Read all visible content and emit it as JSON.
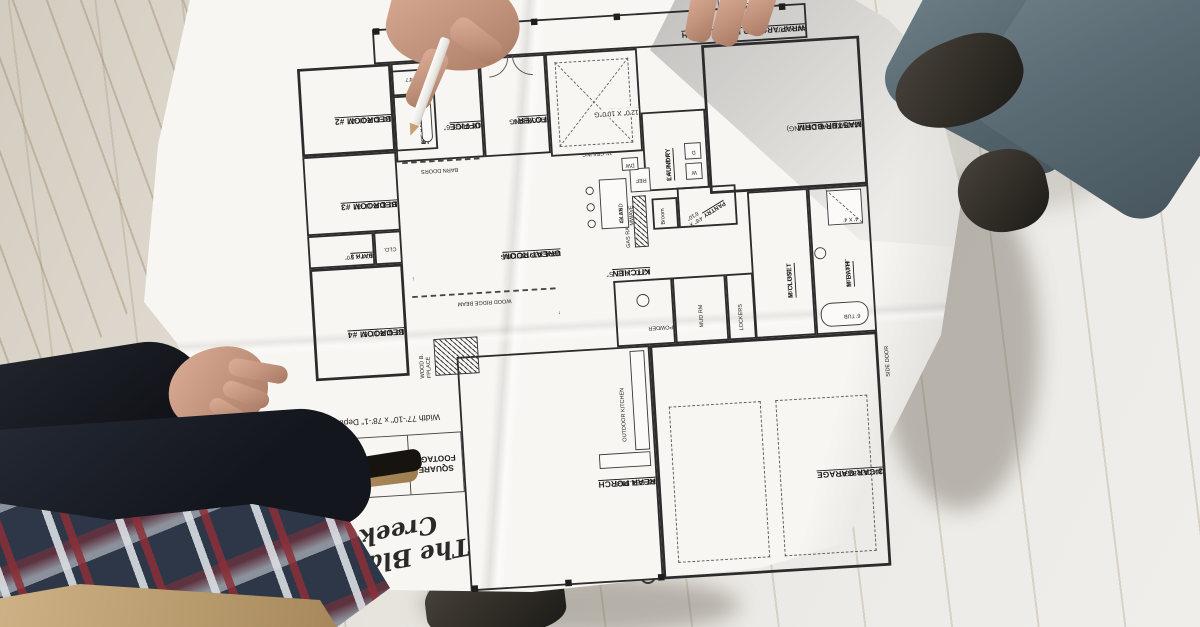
{
  "title_block": {
    "plan_title": "The Black Creek",
    "dimensions_note": "Width 77'-10\" x 78'-1\" Depth",
    "square_footage": {
      "header": "SQUARE FOOTAGE",
      "rows": [
        {
          "label": "LIVING",
          "value": "2400"
        },
        {
          "label": "TOTAL SQ. FT.",
          "value": "4064"
        }
      ]
    }
  },
  "rooms": {
    "front_porch": {
      "name": "WRAP AROUND FRONT PORCH",
      "dims": "44' X 6'0\""
    },
    "rear_porch": {
      "name": "REAR PORCH",
      "ceiling": "10' CEILING",
      "dims": "31'-8\" X 13'-6\""
    },
    "garage": {
      "name": "3-CAR GARAGE",
      "ceiling": "10' CEILING",
      "dims": "24'-0\" X 37'-4\""
    },
    "side_door": {
      "name": "SIDE DOOR"
    },
    "foyer": {
      "name": "FOYER",
      "ceiling": "11' CEILING",
      "dims": "7'-0\" X 8'-6\""
    },
    "dining": {
      "name": "DINING",
      "ceiling": "12' TRAY CLG",
      "dims": "12'0\" X 10'0\""
    },
    "office": {
      "name": "OFFICE",
      "ceiling": "10' CLG",
      "dims": "12'-0 X 8'-6\""
    },
    "great_room": {
      "name": "GREAT ROOM",
      "ceiling": "VAULTED CEILING",
      "dims": "19'-4 X 19'-8\""
    },
    "kitchen": {
      "name": "KITCHEN",
      "dims": "12'-0\" X 18'-5\"",
      "note": "11' CEILING"
    },
    "island": {
      "name": "ISLAND",
      "dims": "4X 8'6"
    },
    "bedroom2": {
      "name": "BEDROOM #2",
      "ceiling": "10' CLG",
      "dims": "11'-2\" X 11'-2\""
    },
    "bedroom3": {
      "name": "BEDROOM #3",
      "ceiling": "10' CLG",
      "dims": "11'-0\" X 11'-3\""
    },
    "bedroom4": {
      "name": "BEDROOM #4",
      "ceiling": "10' CLG",
      "dims": "12'-0\" X 11'-5\""
    },
    "bath2": {
      "name": "BA. 2",
      "dims": "10'5 X 5'8"
    },
    "closet2": {
      "dims": "5'5 X 4'7"
    },
    "bath3": {
      "name": "BATH 3",
      "dims": "10'4\" X 5'0\""
    },
    "clo": {
      "name": "CLO."
    },
    "laundry": {
      "name": "LAUNDRY",
      "dims": "8'-8\" X 9'-4\""
    },
    "pantry": {
      "name": "PANTRY",
      "dims": "4'8\" X 6'10\""
    },
    "master": {
      "name": "MASTER BDRM",
      "ceiling": "(CATHEDRAL CEILING)",
      "dims": "15'-0\" X 17'-0\""
    },
    "m_closet": {
      "name": "M CLOSET",
      "dims": "5'6\" X 14'0\""
    },
    "m_bath": {
      "name": "M BATH",
      "dims": "9'8\" X 14'0\""
    },
    "mud_rm": {
      "name": "MUD RM"
    },
    "lockers": {
      "name": "LOCKERS"
    },
    "powder": {
      "name": "POWDER"
    },
    "outdoor_kitchen": {
      "name": "OUTDOOR KITCHEN"
    }
  },
  "annotations": {
    "wood_ridge_beam": "WOOD RIDGE BEAM",
    "barn_doors": "BARN DOORS",
    "fireplace": "WOOD B. FPLACE",
    "gas_range": "GAS RANGE",
    "mwave": "MWAVE",
    "dw": "DW",
    "ref": "REF",
    "washer": "W",
    "dryer": "D",
    "broom": "Broom",
    "tub": "6' TUB",
    "shower": "4' X 4'",
    "arrow_up": "↑",
    "arrow_down": "↓"
  },
  "colors": {
    "paper": "#f7f6f3",
    "ink": "#2b2b2b",
    "floor_light": "#edebe7",
    "floor_warm": "#d3ccc0",
    "jeans": "#5c6d76",
    "boot": "#2e2b25",
    "skin": "#c2937c",
    "jacket": "#151820",
    "plaid_navy": "#2e3748",
    "plaid_red": "#8c2f38",
    "plaid_white": "#d9dde2",
    "khaki": "#c2a478",
    "pencil": "#f1efeb"
  }
}
